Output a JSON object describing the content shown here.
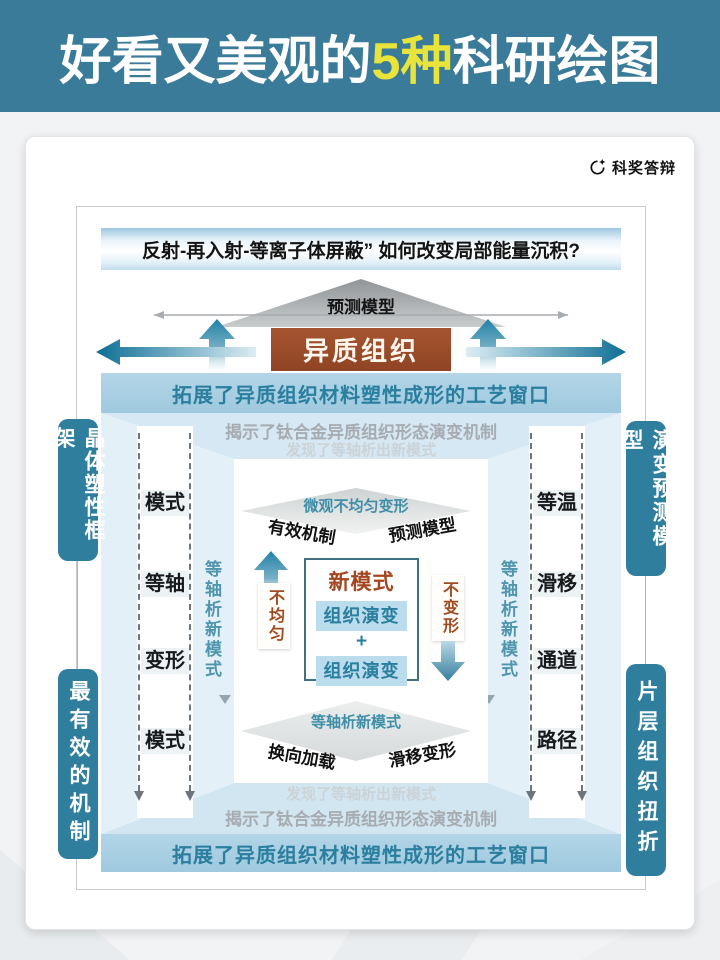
{
  "title": {
    "prefix": "好看又美观的",
    "highlight": "5种",
    "suffix": "科研绘图"
  },
  "brand": {
    "name": "科奖答辩"
  },
  "question": "反射-再入射-等离子体屏蔽” 如何改变局部能量沉积?",
  "top": {
    "model_label": "预测模型",
    "hetero_label": "异质组织",
    "band": "拓展了异质组织材料塑性成形的工艺窗口",
    "reveal": "揭示了钛合金异质组织形态演变机制",
    "discover": "发现了等轴析出新模式"
  },
  "bottom": {
    "discover": "发现了等轴析出新模式",
    "reveal": "揭示了钛合金异质组织形态演变机制",
    "band": "拓展了异质组织材料塑性成形的工艺窗口"
  },
  "columns": {
    "left": [
      "模式",
      "等轴",
      "变形",
      "模式"
    ],
    "right": [
      "等温",
      "滑移",
      "通道",
      "路径"
    ]
  },
  "axes": {
    "left": "等轴析新模式",
    "right": "等轴析新模式"
  },
  "center": {
    "top_diamond": {
      "title": "微观不均匀变形",
      "left": "有效机制",
      "right": "预测模型"
    },
    "core": {
      "title": "新模式",
      "item1": "组织演变",
      "plus": "+",
      "item2": "组织演变"
    },
    "up_label": "不均匀",
    "down_label": "不变形",
    "bottom_diamond": {
      "title": "等轴析新模式",
      "left": "换向加载",
      "right": "滑移变形"
    }
  },
  "pills": {
    "left_top": "晶体塑性框架",
    "left_bottom": "最有效的机制",
    "right_top": "演变预测模型",
    "right_bottom": "片层组织扭折"
  },
  "colors": {
    "banner_teal": "#3a7b99",
    "highlight_yellow": "#e9e43c",
    "pill_teal": "#2f7e9d",
    "brown_box": "#9c4e2b",
    "band_blue": "#a9cfe3",
    "band_text": "#2a7e9e",
    "frame_blue": "#d5e8f3",
    "arrow_teal": "#0e6f95"
  }
}
